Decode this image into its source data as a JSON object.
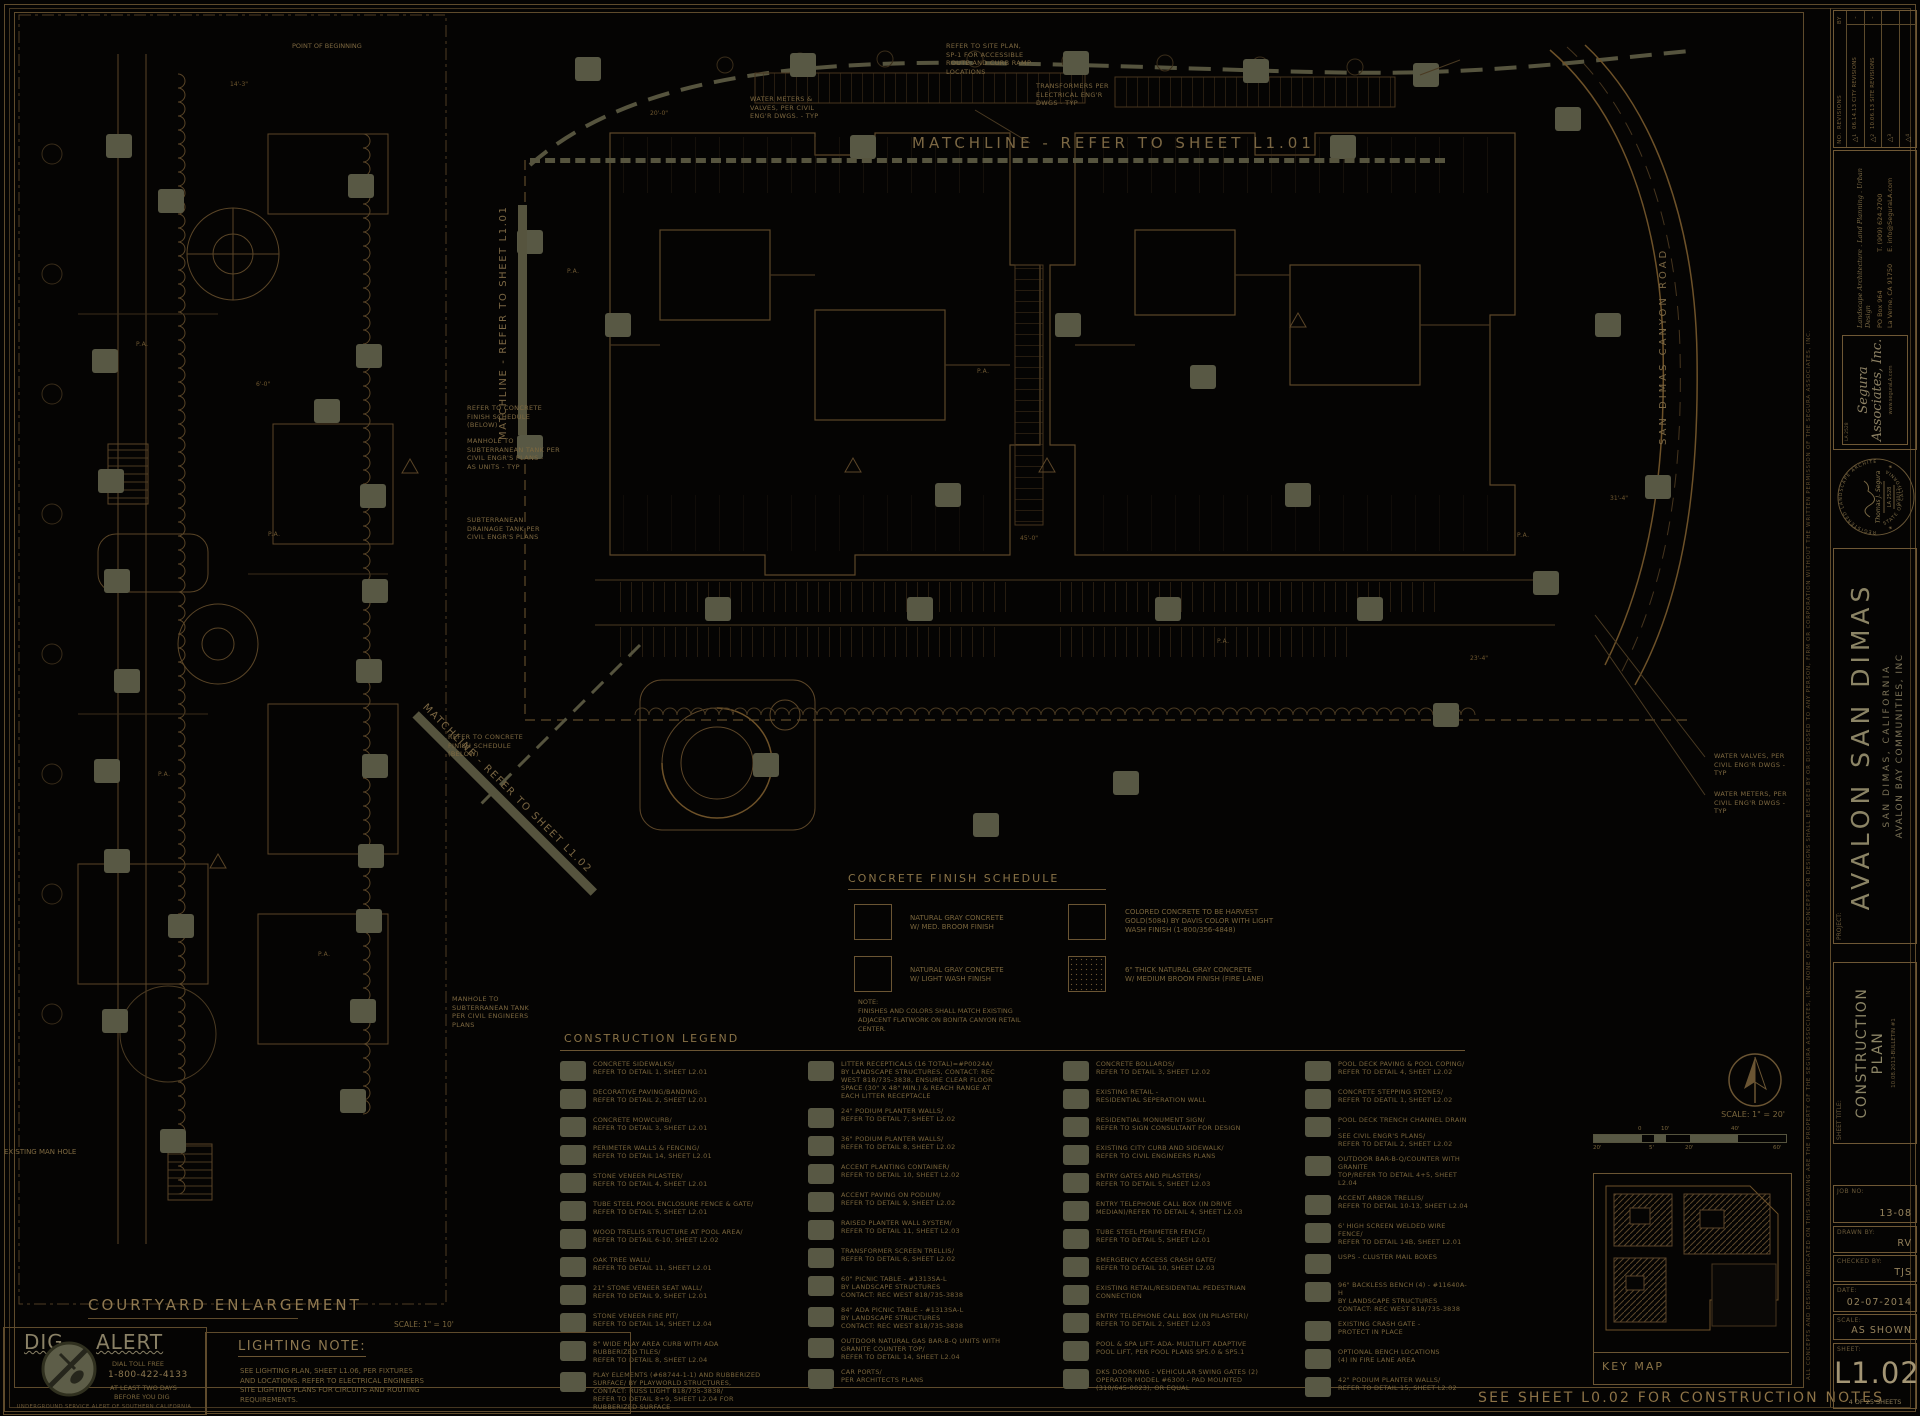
{
  "colors": {
    "background": "#050403",
    "line_brown": "#5c4728",
    "text_tan": "#8c7347",
    "olive_fill": "#585844",
    "bright_text": "#a39574"
  },
  "icons": {
    "delta": "△",
    "star": "★",
    "north_arrow": "north-arrow"
  },
  "sheet": {
    "bottom_note": "SEE SHEET L0.02 FOR CONSTRUCTION NOTES"
  },
  "matchlines": {
    "top": "MATCHLINE - REFER TO SHEET L1.01",
    "left": "MATCHLINE - REFER TO SHEET L1.01",
    "diagonal": "MATCHLINE - REFER TO SHEET L1.02"
  },
  "plan": {
    "road_label": "SAN DIMAS CANYON ROAD",
    "pa_label": "P.A.",
    "point_of_beginning": "POINT OF BEGINNING",
    "dims": [
      "20'-0\"",
      "45'-0\"",
      "23'-4\"",
      "14'-3\"",
      "6'-0\"",
      "31'-4\""
    ]
  },
  "annotations": [
    {
      "text": "REFER TO SITE PLAN,\nSP-1 FOR ACCESSIBLE\nROUTE AND CURB RAMP\nLOCATIONS"
    },
    {
      "text": "WATER METERS &\nVALVES, PER CIVIL\nENG'R DWGS. - TYP"
    },
    {
      "text": "TRANSFORMERS PER\nELECTRICAL ENG'R\nDWGS - TYP"
    },
    {
      "text": "REFER TO CONCRETE\nFINISH SCHEDULE\n(BELOW)"
    },
    {
      "text": "MANHOLE TO\nSUBTERRANEAN TANK PER\nCIVIL ENGR'S PLANS -\nAS UNITS - TYP"
    },
    {
      "text": "SUBTERRANEAN\nDRAINAGE TANK PER\nCIVIL ENGR'S PLANS"
    },
    {
      "text": "REFER TO CONCRETE\nFINISH SCHEDULE\n(BELOW)"
    },
    {
      "text": "MANHOLE TO\nSUBTERRANEAN TANK\nPER CIVIL ENGINEERS\nPLANS"
    },
    {
      "text": "WATER VALVES, PER\nCIVIL ENG'R DWGS -\nTYP"
    },
    {
      "text": "WATER METERS, PER\nCIVIL ENG'R DWGS -\nTYP"
    }
  ],
  "courtyard": {
    "title": "COURTYARD ENLARGEMENT",
    "scale": "SCALE: 1\" = 10'",
    "existing_manhole": "EXISTING MAN HOLE"
  },
  "finish_schedule": {
    "title": "CONCRETE FINISH SCHEDULE",
    "items": [
      {
        "text": "NATURAL GRAY CONCRETE\nW/ MED. BROOM FINISH"
      },
      {
        "text": "NATURAL GRAY CONCRETE\nW/ LIGHT WASH FINISH"
      },
      {
        "text": "COLORED CONCRETE TO BE HARVEST\nGOLD(5084) BY DAVIS COLOR WITH LIGHT\nWASH FINISH (1-800/356-4848)"
      },
      {
        "text": "6\" THICK NATURAL GRAY CONCRETE\nW/ MEDIUM BROOM FINISH (FIRE LANE)"
      }
    ],
    "note": "NOTE:\nFINISHES AND COLORS SHALL MATCH EXISTING\nADJACENT FLATWORK ON BONITA CANYON RETAIL\nCENTER."
  },
  "legend": {
    "title": "CONSTRUCTION LEGEND",
    "col1": [
      {
        "text": "CONCRETE SIDEWALKS/\nREFER TO DETAIL 1, SHEET L2.01"
      },
      {
        "text": "DECORATIVE PAVING/BANDING:\nREFER TO DETAIL 2, SHEET L2.01"
      },
      {
        "text": "CONCRETE MOWCURB/\nREFER TO DETAIL 3, SHEET L2.01"
      },
      {
        "text": "PERIMETER WALLS & FENCING/\nREFER TO DETAIL 14, SHEET L2.01"
      },
      {
        "text": "STONE VENEER PILASTER/\nREFER TO DETAIL 4, SHEET L2.01"
      },
      {
        "text": "TUBE STEEL POOL ENCLOSURE FENCE & GATE/\nREFER TO DETAIL 5, SHEET L2.01"
      },
      {
        "text": "WOOD TRELLIS STRUCTURE AT POOL AREA/\nREFER TO DETAIL 6-10, SHEET L2.02"
      },
      {
        "text": "OAK TREE WALL/\nREFER TO DETAIL 11, SHEET L2.01"
      },
      {
        "text": "21\" STONE VENEER SEAT WALL/\nREFER TO DETAIL 9, SHEET L2.01"
      },
      {
        "text": "STONE VENEER FIRE PIT/\nREFER TO DETAIL 14, SHEET L2.04"
      },
      {
        "text": "8\" WIDE PLAY AREA CURB WITH ADA\nRUBBERIZED TILES/\nREFER TO DETAIL 8, SHEET L2.04"
      },
      {
        "text": "PLAY ELEMENTS (#68744-1-1) AND RUBBERIZED\nSURFACE/ BY PLAYWORLD STRUCTURES,\nCONTACT: RUSS LIGHT 818/735-3838/\nREFER TO DETAIL 8+9, SHEET L2.04 FOR\nRUBBERIZED SURFACE"
      }
    ],
    "col2": [
      {
        "text": "LITTER RECEPTICALS (16 TOTAL)=#P0024A/\nBY LANDSCAPE STRUCTURES, CONTACT: REC\nWEST 818/735-3838, ENSURE CLEAR FLOOR\nSPACE (30\" x 48\" MIN.) & REACH RANGE AT\nEACH LITTER RECEPTACLE"
      },
      {
        "text": "24\" PODIUM PLANTER WALLS/\nREFER TO DETAIL 7, SHEET L2.02"
      },
      {
        "text": "36\" PODIUM PLANTER WALLS/\nREFER TO DETAIL 8, SHEET L2.02"
      },
      {
        "text": "ACCENT PLANTING CONTAINER/\nREFER TO DETAIL 10, SHEET L2.02"
      },
      {
        "text": "ACCENT PAVING ON PODIUM/\nREFER TO DETAIL 9, SHEET L2.02"
      },
      {
        "text": "RAISED PLANTER WALL SYSTEM/\nREFER TO DETAIL 11, SHEET L2.03"
      },
      {
        "text": "TRANSFORMER SCREEN TRELLIS/\nREFER TO DETAIL 6, SHEET L2.02"
      },
      {
        "text": "60\" PICNIC TABLE - #1313SA-L\nBY LANDSCAPE STRUCTURES\nCONTACT: REC WEST 818/735-3838"
      },
      {
        "text": "84\" ADA PICNIC TABLE - #1313SA-L\nBY LANDSCAPE STRUCTURES\nCONTACT: REC WEST 818/735-3838"
      },
      {
        "text": "OUTDOOR NATURAL GAS BAR-B-Q UNITS WITH\nGRANITE COUNTER TOP/\nREFER TO DETAIL 14, SHEET L2.04"
      },
      {
        "text": "CAR PORTS/\nPER ARCHITECTS PLANS"
      }
    ],
    "col3": [
      {
        "text": "CONCRETE BOLLARDS/\nREFER TO DETAIL 3, SHEET L2.02"
      },
      {
        "text": "EXISTING RETAIL -\nRESIDENTIAL SEPERATION WALL"
      },
      {
        "text": "RESIDENTIAL MONUMENT SIGN/\nREFER TO SIGN CONSULTANT FOR DESIGN"
      },
      {
        "text": "EXISTING CITY CURB AND SIDEWALK/\nREFER TO CIVIL ENGINEERS PLANS"
      },
      {
        "text": "ENTRY GATES AND PILASTERS/\nREFER TO DETAIL 5, SHEET L2.03"
      },
      {
        "text": "ENTRY TELEPHONE CALL BOX (IN DRIVE\nMEDIAN)/REFER TO DETAIL 4, SHEET L2.03"
      },
      {
        "text": "TUBE STEEL PERIMETER FENCE/\nREFER TO DETAIL 5, SHEET L2.01"
      },
      {
        "text": "EMERGENCY ACCESS CRASH GATE/\nREFER TO DETAIL 10, SHEET L2.03"
      },
      {
        "text": "EXISTING RETAIL/RESIDENTIAL PEDESTRIAN\nCONNECTION"
      },
      {
        "text": "ENTRY TELEPHONE CALL BOX (IN PILASTER)/\nREFER TO DETAIL 2, SHEET L2.03"
      },
      {
        "text": "POOL & SPA LIFT- ADA- MULTILIFT ADAPTIVE\nPOOL LIFT, PER POOL PLANS SP5.0 & SP5.1"
      },
      {
        "text": "DKS DOORKING - VEHICULAR SWING GATES (2)\nOPERATOR MODEL #6300 - PAD MOUNTED\n(310/645-0023), OR EQUAL"
      }
    ],
    "col4": [
      {
        "text": "POOL DECK PAVING & POOL COPING/\nREFER TO DETAIL 4, SHEET L2.02"
      },
      {
        "text": "CONCRETE STEPPING STONES/\nREFER TO DEATIL 1, SHEET L2.02"
      },
      {
        "text": "POOL DECK TRENCH CHANNEL DRAIN -\nSEE CIVIL ENGR'S PLANS/\nREFER TO DETAIL 2, SHEET L2.02"
      },
      {
        "text": "OUTDOOR BAR-B-Q/COUNTER WITH GRANITE\nTOP/REFER TO DETAIL 4+5, SHEET L2.04"
      },
      {
        "text": "ACCENT ARBOR TRELLIS/\nREFER TO DETAIL 10-13, SHEET L2.04"
      },
      {
        "text": "6' HIGH SCREEN WELDED WIRE FENCE/\nREFER TO DETAIL 14B, SHEET L2.01"
      },
      {
        "text": "USPS - CLUSTER MAIL BOXES"
      },
      {
        "text": "96\" BACKLESS BENCH (4) - #11640A-H\nBY LANDSCAPE STRUCTURES\nCONTACT: REC WEST 818/735-3838"
      },
      {
        "text": "EXISTING CRASH GATE -\nPROTECT IN PLACE"
      },
      {
        "text": "OPTIONAL BENCH LOCATIONS\n(4) IN FIRE LANE AREA"
      },
      {
        "text": "42\" PODIUM PLANTER WALLS/\nREFER TO DETAIL 15, SHEET L2.02"
      }
    ]
  },
  "lighting_note": {
    "title": "LIGHTING NOTE:",
    "body": "SEE LIGHTING PLAN, SHEET L1.06, PER FIXTURES\nAND LOCATIONS. REFER TO ELECTRICAL ENGINEERS\nSITE LIGHTING PLANS FOR CIRCUITS AND ROUTING\nREQUIREMENTS."
  },
  "dig_alert": {
    "word1": "DIG",
    "word2": "ALERT",
    "line1": "DIAL TOLL FREE",
    "phone": "1-800-422-4133",
    "line2": "AT LEAST TWO DAYS",
    "line3": "BEFORE YOU DIG",
    "footer": "UNDERGROUND SERVICE ALERT OF SOUTHERN CALIFORNIA"
  },
  "key_map": {
    "label": "KEY MAP",
    "scale": "SCALE: 1\" = 20'",
    "bar_labels": [
      "20'",
      "0",
      "5'",
      "10'",
      "20'",
      "40'",
      "60'"
    ]
  },
  "titleblock": {
    "revisions": {
      "no": "NO.",
      "title": "REVISIONS",
      "by": "BY",
      "rows": [
        {
          "no": "1",
          "text": "06.14.13  CITY REVISIONS",
          "by": "-"
        },
        {
          "no": "2",
          "text": "10.06.13  SITE REVISIONS",
          "by": "-"
        },
        {
          "no": "3",
          "text": "",
          "by": ""
        },
        {
          "no": "4",
          "text": "",
          "by": ""
        }
      ]
    },
    "firm": {
      "name": "Segura Associates, Inc.",
      "la": "LA 2528",
      "tagline": "Landscape Architecture . Land Planning . Urban Design",
      "addr": "PO Box 964",
      "city": "La Verne, CA 91750",
      "tel": "T. (909) 624-2700",
      "email": "E. info@SeguraLA.com",
      "web": "www.seguraLA.com"
    },
    "stamp": {
      "top": "REGISTERED LANDSCAPE ARCHITECT",
      "name": "Thomas J. Segura",
      "la": "LA 2528",
      "date": "9/30/13",
      "bottom": "STATE OF CALIFORNIA"
    },
    "project": {
      "label": "PROJECT:",
      "name": "AVALON SAN DIMAS",
      "city": "SAN DIMAS, CALIFORNIA",
      "client": "AVALON BAY COMMUNITIES, INC"
    },
    "sheet_title": {
      "label": "SHEET TITLE:",
      "line1": "CONSTRUCTION",
      "line2": "PLAN",
      "bulletin": "10.08.2013-BULLETIN #1"
    },
    "job": {
      "label": "JOB NO:",
      "value": "13-08"
    },
    "drawn": {
      "label": "DRAWN BY:",
      "value": "RV"
    },
    "checked": {
      "label": "CHECKED BY:",
      "value": "TJS"
    },
    "date": {
      "label": "DATE:",
      "value": "02-07-2014"
    },
    "scale": {
      "label": "SCALE:",
      "value": "AS SHOWN"
    },
    "sheet": {
      "label": "SHEET:",
      "number": "L1.02",
      "count": "4  OF 25 SHEETS"
    },
    "disclaimer": "ALL CONCEPTS AND DESIGNS INDICATED ON THIS DRAWING ARE THE PROPERTY OF THE SEGURA ASSOCIATES, INC.   NONE OF SUCH CONCEPTS OR DESIGNS SHALL BE USED BY OR DISCLOSED TO ANY PERSON, FIRM OR CORPORATION WITHOUT THE WRITTEN PERMISSION OF THE SEGURA ASSOCIATES, INC."
  }
}
